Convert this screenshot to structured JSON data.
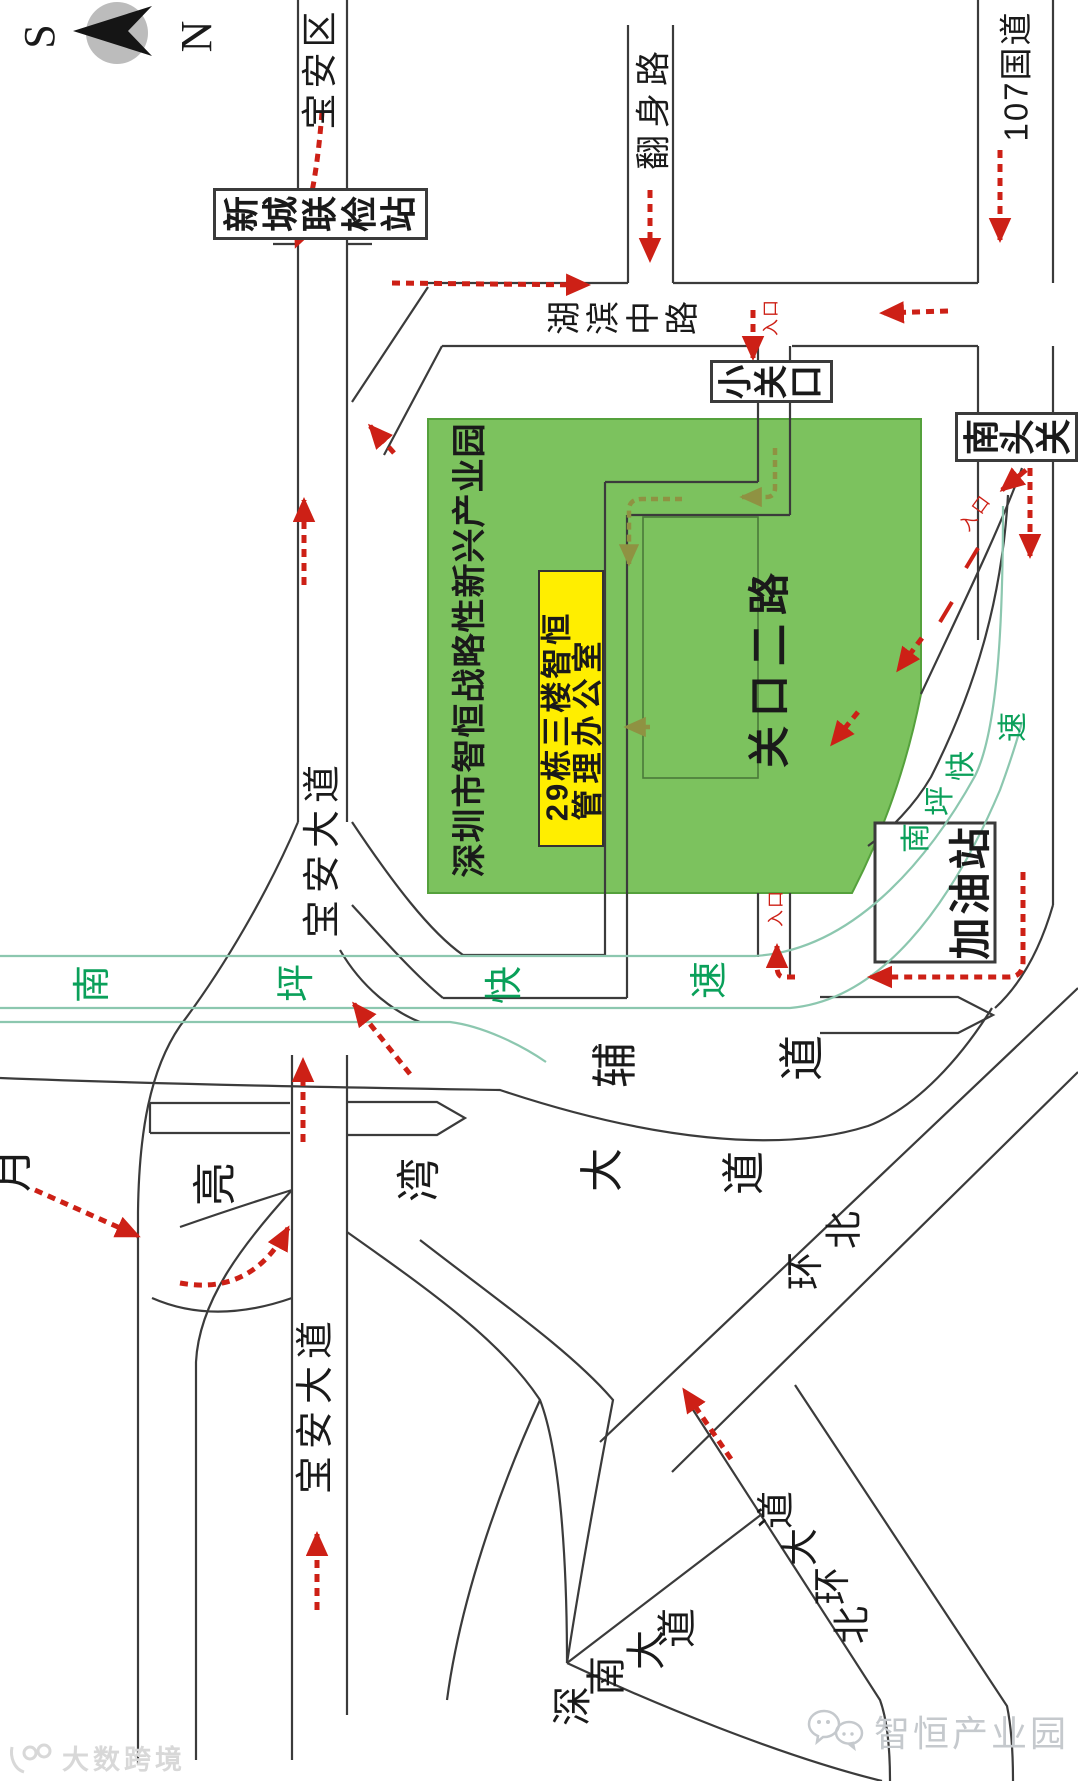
{
  "compass": {
    "south": "S",
    "north": "N"
  },
  "districts": {
    "baoan": "宝安区"
  },
  "stations": {
    "checkpoint": "新城联检站",
    "xiaoguankou": "小关口",
    "nantouguan": "南头关",
    "gas_station": "加油站"
  },
  "roads": {
    "fanshen": "翻身路",
    "g107": "107国道",
    "hubin": "湖滨中路",
    "guankou2": "关口二路",
    "baoan_avenue": "宝安大道",
    "nanping_expressway": "南坪快速",
    "fudao": "辅道",
    "yueliangwan": "月亮湾大道",
    "beihuan": "北环",
    "beihuan_avenue": "北环大道",
    "shennan_avenue": "深南大道"
  },
  "park": {
    "name": "深圳市智恒战略性新兴产业园",
    "office_line1": "29栋三楼智恒",
    "office_line2": "管理办公室"
  },
  "markers": {
    "entrance": "入口"
  },
  "watermarks": {
    "brand": "智恒产业园",
    "platform": "大数跨境"
  },
  "colors": {
    "park_green": "#7cc25e",
    "highlight_yellow": "#ffee00",
    "arrow_red": "#cd2016",
    "route_olive": "#8f9242",
    "expressway_green": "#0aa05a"
  }
}
